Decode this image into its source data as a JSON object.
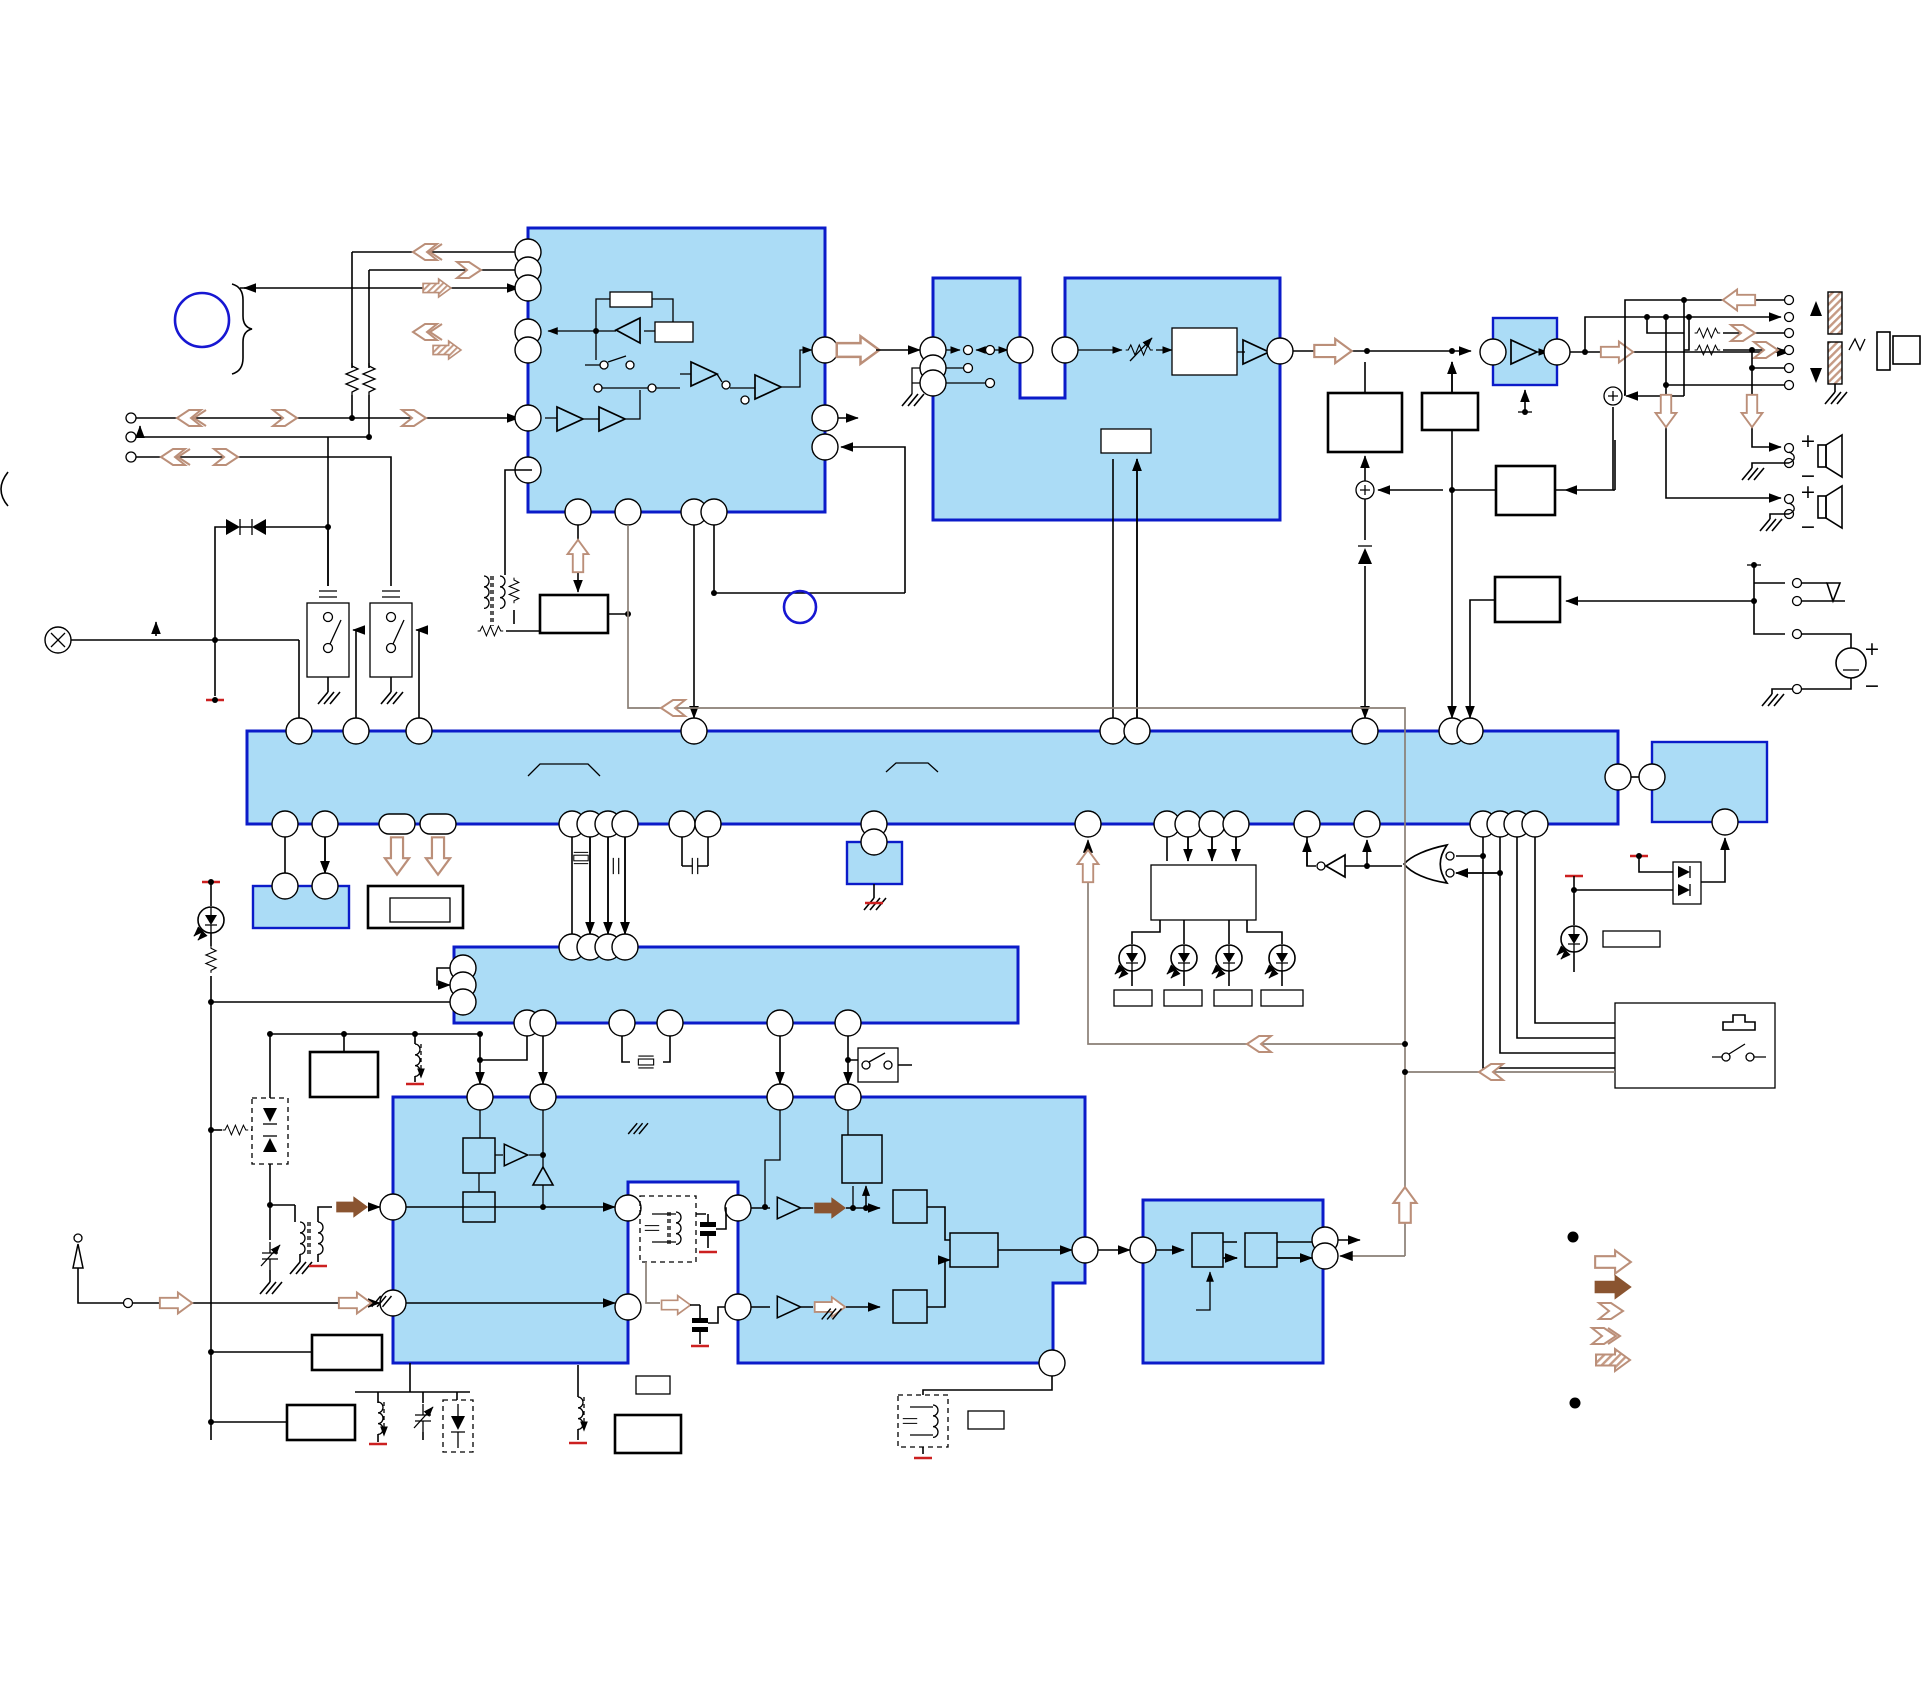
{
  "canvas": {
    "width": 1925,
    "height": 1684,
    "background": "#ffffff",
    "kind": "audio-system-block-diagram"
  },
  "colors": {
    "block_fill": "#abdcf6",
    "block_stroke": "#0b1bc9",
    "wire": "#000000",
    "control_wire": "#8a7f76",
    "arrow_brown": "#8a5430",
    "arrow_light": "#bb8f79",
    "power_tick": "#cc2020",
    "symbol_blue": "#1717d2"
  },
  "signs": {
    "plus": "+",
    "minus": "−"
  },
  "legend": {
    "bullet_count": 2,
    "arrow_styles": [
      "outline-block-arrow",
      "solid-block-arrow",
      "single-chevron-arrow",
      "double-chevron-arrow",
      "hatched-block-arrow"
    ]
  },
  "inventory": {
    "blue_ic_blocks": 9,
    "leds": 5,
    "speakers": 2,
    "crystals": 2,
    "battery": 1,
    "headphone_jack": 1,
    "antenna": 1
  }
}
